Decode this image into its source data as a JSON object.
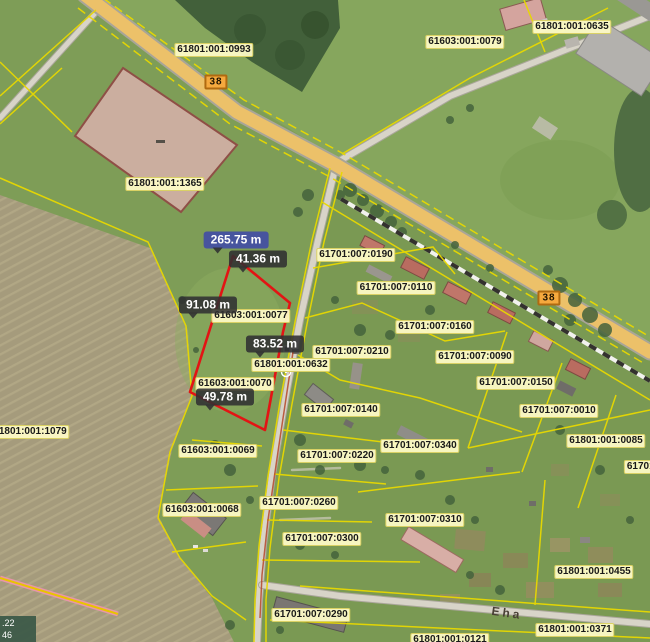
{
  "map": {
    "kind": "cadastral-orthophoto-map",
    "street": {
      "text": "Eha",
      "x": 507,
      "y": 613
    },
    "coords_box": {
      "line1": ".22",
      "line2": "46"
    },
    "road_markers": [
      {
        "text": "38",
        "x": 216,
        "y": 82
      },
      {
        "text": "38",
        "x": 549,
        "y": 298
      }
    ],
    "measurements": {
      "total": {
        "text": "265.75 m",
        "x": 236,
        "y": 240
      },
      "segments": [
        {
          "text": "41.36 m",
          "x": 258,
          "y": 259
        },
        {
          "text": "91.08 m",
          "x": 208,
          "y": 305
        },
        {
          "text": "83.52 m",
          "x": 275,
          "y": 344
        },
        {
          "text": "49.78 m",
          "x": 225,
          "y": 397
        }
      ]
    },
    "parcel_labels": [
      {
        "text": "61801:001:0993",
        "x": 214,
        "y": 50
      },
      {
        "text": "61603:001:0079",
        "x": 465,
        "y": 42
      },
      {
        "text": "61801:001:0635",
        "x": 572,
        "y": 27
      },
      {
        "text": "61801:001:1365",
        "x": 165,
        "y": 184
      },
      {
        "text": "61701:007:0190",
        "x": 356,
        "y": 255
      },
      {
        "text": "61701:007:0110",
        "x": 396,
        "y": 288
      },
      {
        "text": "61701:007:0160",
        "x": 435,
        "y": 327
      },
      {
        "text": "61603:001:0077",
        "x": 251,
        "y": 316
      },
      {
        "text": "61701:007:0210",
        "x": 352,
        "y": 352
      },
      {
        "text": "61701:007:0090",
        "x": 475,
        "y": 357
      },
      {
        "text": "61801:001:0632",
        "x": 291,
        "y": 365
      },
      {
        "text": "61701:007:0150",
        "x": 516,
        "y": 383
      },
      {
        "text": "61603:001:0070",
        "x": 235,
        "y": 384
      },
      {
        "text": "61701:007:0140",
        "x": 341,
        "y": 410
      },
      {
        "text": "61701:007:0010",
        "x": 559,
        "y": 411
      },
      {
        "text": "61801:001:1079",
        "x": 30,
        "y": 432
      },
      {
        "text": "61801:001:0085",
        "x": 606,
        "y": 441
      },
      {
        "text": "61701:007:0340",
        "x": 420,
        "y": 446
      },
      {
        "text": "61603:001:0069",
        "x": 218,
        "y": 451
      },
      {
        "text": "61701:007:0220",
        "x": 337,
        "y": 456
      },
      {
        "text": "61701:00",
        "x": 648,
        "y": 467
      },
      {
        "text": "61701:007:0260",
        "x": 299,
        "y": 503
      },
      {
        "text": "61603:001:0068",
        "x": 202,
        "y": 510
      },
      {
        "text": "61701:007:0310",
        "x": 425,
        "y": 520
      },
      {
        "text": "61701:007:0300",
        "x": 322,
        "y": 539
      },
      {
        "text": "61801:001:0455",
        "x": 594,
        "y": 572
      },
      {
        "text": "61701:007:0290",
        "x": 311,
        "y": 615
      },
      {
        "text": "61801:001:0371",
        "x": 575,
        "y": 630
      },
      {
        "text": "61801:001:0121",
        "x": 450,
        "y": 640
      }
    ],
    "colors": {
      "grass": "#7e9d57",
      "field": "#a59b7c",
      "forest": "#42603a",
      "highway_fill": "#ecc169",
      "minor_road": "#d8d4c8",
      "cadastral_line": "#e8d800",
      "measure_line": "#e31414",
      "selected_parcel_fill": "#d8b2ac",
      "label_bg": "#fdfac6",
      "measure_label_bg": "#303032",
      "measure_total_bg": "#47549e",
      "road_marker_bg": "#f5a93e"
    }
  }
}
